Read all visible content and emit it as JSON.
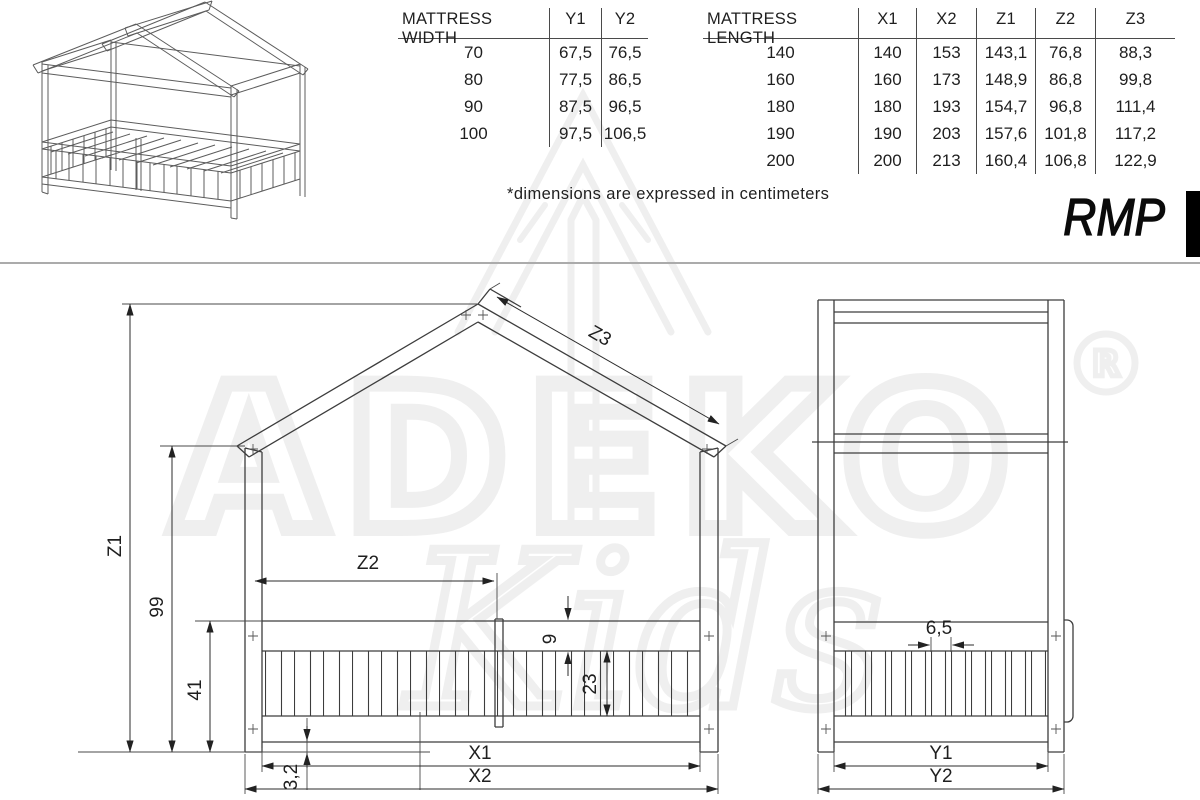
{
  "sheet": {
    "model_label": "RMP",
    "note": "*dimensions are expressed in centimeters"
  },
  "watermark": {
    "brand": "ADEKO",
    "registered_mark": "R",
    "sub_brand": "Kids"
  },
  "tables": {
    "mattress_width": {
      "headers": [
        "MATTRESS WIDTH",
        "Y1",
        "Y2"
      ],
      "rows": [
        [
          "70",
          "67,5",
          "76,5"
        ],
        [
          "80",
          "77,5",
          "86,5"
        ],
        [
          "90",
          "87,5",
          "96,5"
        ],
        [
          "100",
          "97,5",
          "106,5"
        ]
      ]
    },
    "mattress_length": {
      "headers": [
        "MATTRESS LENGTH",
        "X1",
        "X2",
        "Z1",
        "Z2",
        "Z3"
      ],
      "rows": [
        [
          "140",
          "140",
          "153",
          "143,1",
          "76,8",
          "88,3"
        ],
        [
          "160",
          "160",
          "173",
          "148,9",
          "86,8",
          "99,8"
        ],
        [
          "180",
          "180",
          "193",
          "154,7",
          "96,8",
          "111,4"
        ],
        [
          "190",
          "190",
          "203",
          "157,6",
          "101,8",
          "117,2"
        ],
        [
          "200",
          "200",
          "213",
          "160,4",
          "106,8",
          "122,9"
        ]
      ]
    }
  },
  "front_view": {
    "labels": {
      "z1": "Z1",
      "height_99": "99",
      "height_41": "41",
      "z2": "Z2",
      "z3": "Z3",
      "rail_9": "9",
      "slat_23": "23",
      "gap_3_2": "3,2",
      "x1": "X1",
      "x2": "X2"
    }
  },
  "side_view": {
    "labels": {
      "spacing_6_5": "6,5",
      "y1": "Y1",
      "y2": "Y2"
    }
  },
  "colors": {
    "line": "#3d3d3d",
    "dim": "#2b2b2b",
    "ext": "#4a4a4a",
    "rule": "#4a4a4a",
    "text": "#1f1f1f",
    "watermark": "#efefef",
    "divider": "#ababab"
  }
}
